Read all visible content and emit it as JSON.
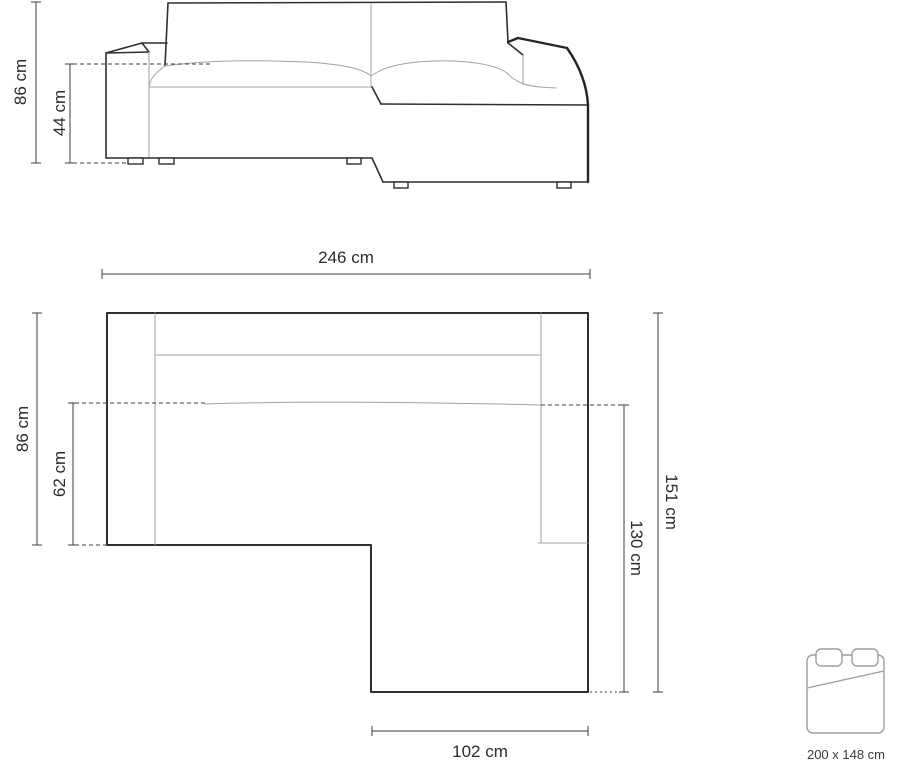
{
  "front_view": {
    "overall_height": "86 cm",
    "seat_height": "44 cm"
  },
  "top_view": {
    "overall_width": "246 cm",
    "overall_depth": "86 cm",
    "seat_depth": "62 cm",
    "chaise_side_length": "151 cm",
    "chaise_inner_length": "130 cm",
    "chaise_width": "102 cm"
  },
  "sleeping_area": {
    "size_label": "200 x 148 cm"
  },
  "colors": {
    "outline": "#2f2f2f",
    "inner_line": "#a3a3a3",
    "dimension_line": "#3d3d3d",
    "label": "#2b2b2b",
    "bed_icon": "#9e9e9e",
    "background": "#ffffff"
  }
}
